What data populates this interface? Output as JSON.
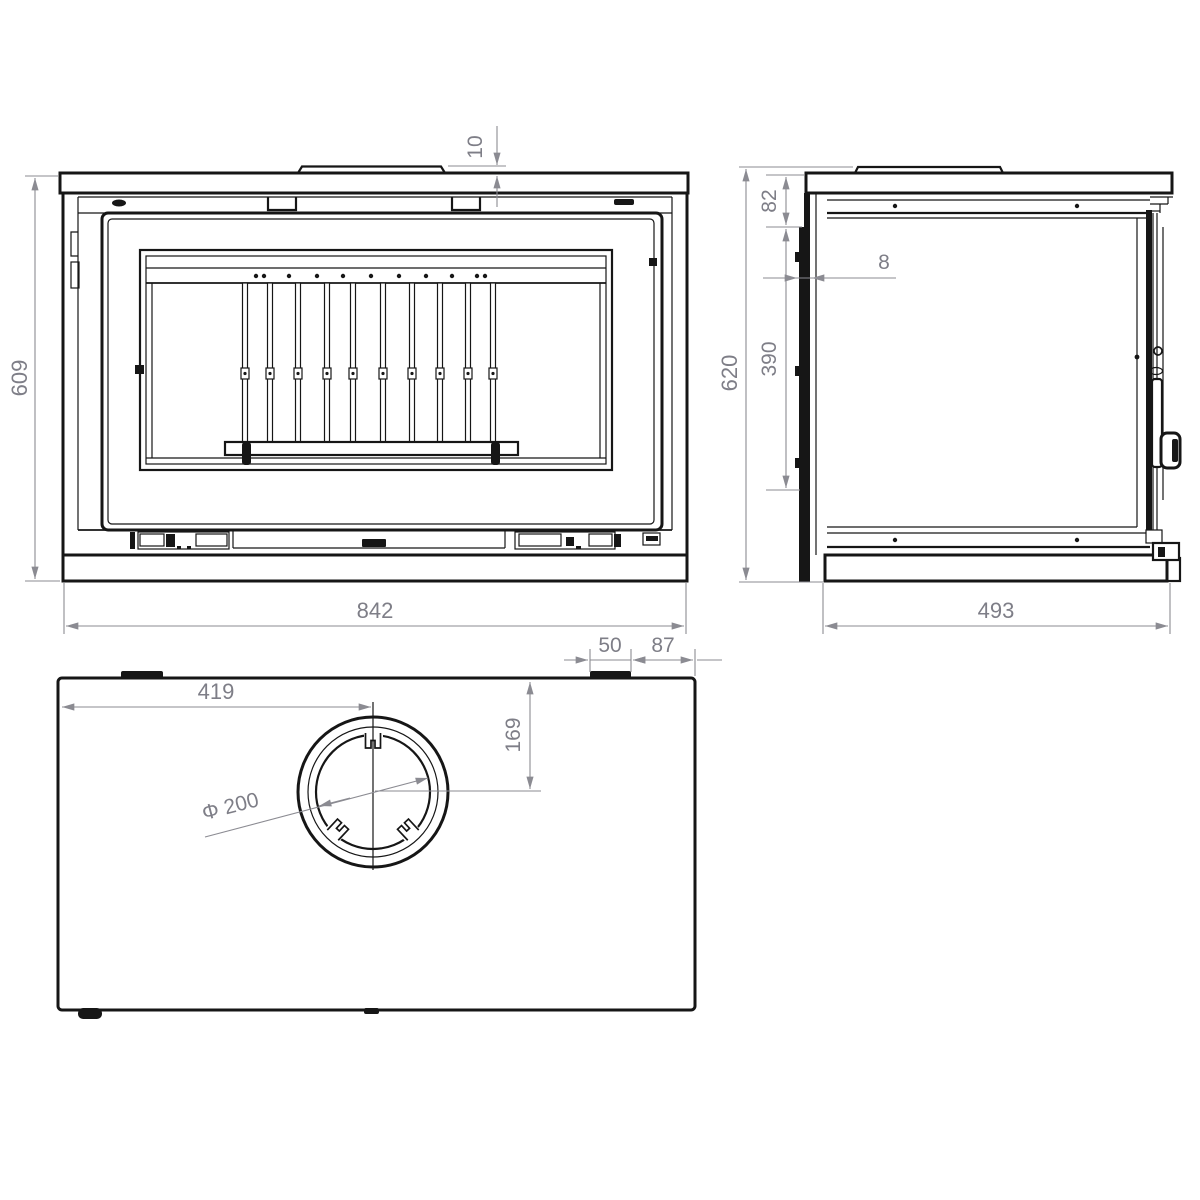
{
  "drawing": {
    "type": "stove-three-view-technical-drawing",
    "line_color": "#161616",
    "dimension_color": "#8b8b92",
    "background": "#ffffff"
  },
  "dimensions": {
    "front_view": {
      "overall_height": "609",
      "overall_width": "842",
      "top_shield_height": "10"
    },
    "side_view": {
      "overall_height": "620",
      "top_section": "82",
      "panel_thickness": "8",
      "mid_section": "390",
      "overall_depth": "493"
    },
    "top_view": {
      "flue_centre_from_left": "419",
      "flue_centre_from_back": "169",
      "flue_diameter": "Φ 200",
      "bracket_width": "50",
      "bracket_to_edge": "87"
    }
  }
}
